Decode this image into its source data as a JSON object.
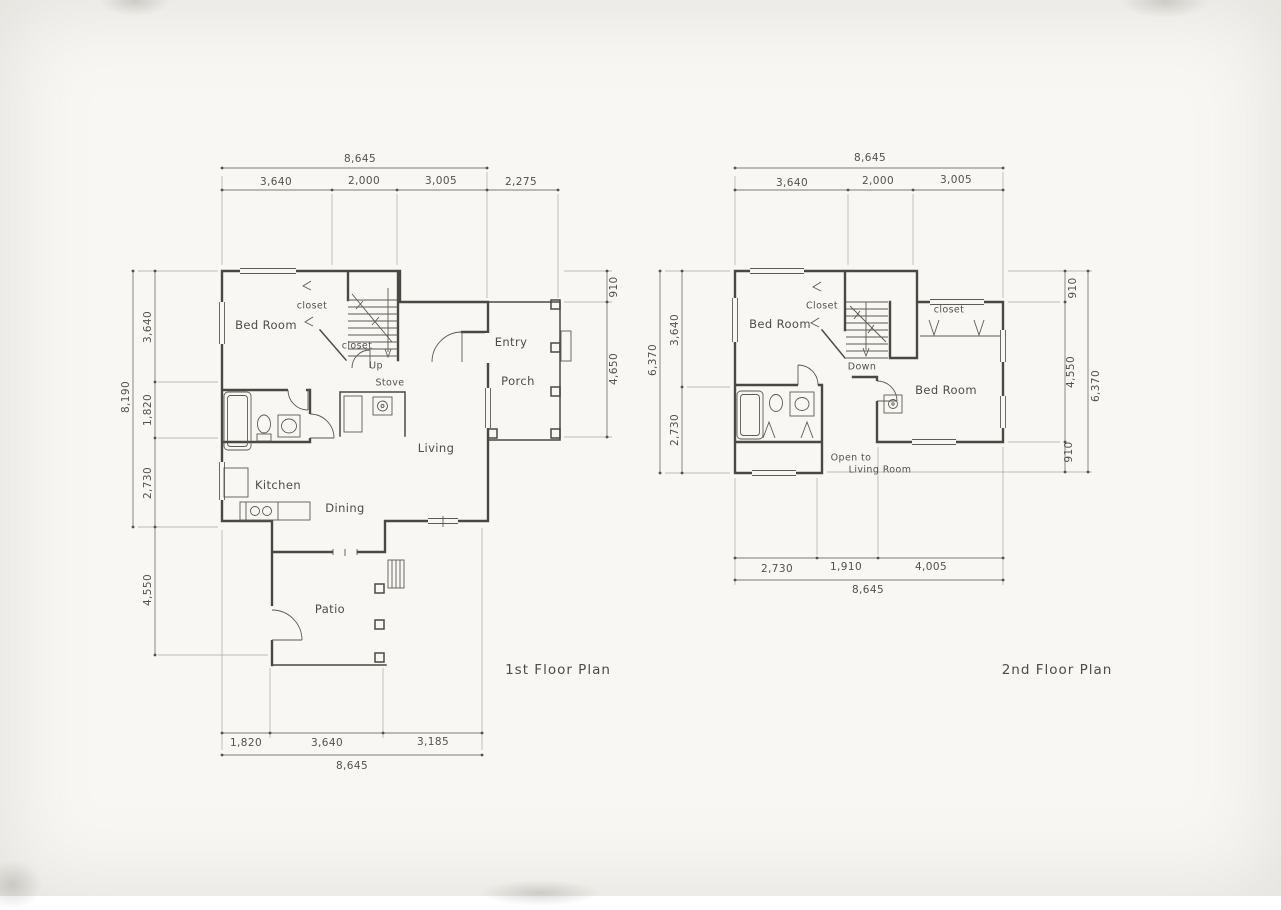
{
  "sheet": {
    "paper_color": "#f8f7f3",
    "ink_color": "#4a4840",
    "dim_color": "#7d7b73"
  },
  "first_floor": {
    "caption": "1st Floor Plan",
    "dims": {
      "top_overall": "8,645",
      "top_1": "3,640",
      "top_2": "2,000",
      "top_3": "3,005",
      "top_4": "2,275",
      "left_overall": "8,190",
      "left_1": "3,640",
      "left_2": "1,820",
      "left_3": "2,730",
      "left_4": "4,550",
      "right_1": "910",
      "right_2": "4,650",
      "bottom_1": "1,820",
      "bottom_2": "3,640",
      "bottom_3": "3,185",
      "bottom_overall": "8,645"
    },
    "labels": {
      "bedroom": "Bed Room",
      "closet_upper": "closet",
      "closet_stair": "closet",
      "up": "Up",
      "stove": "Stove",
      "entry": "Entry",
      "porch": "Porch",
      "living": "Living",
      "kitchen": "Kitchen",
      "dining": "Dining",
      "patio": "Patio"
    }
  },
  "second_floor": {
    "caption": "2nd Floor Plan",
    "dims": {
      "top_overall": "8,645",
      "top_1": "3,640",
      "top_2": "2,000",
      "top_3": "3,005",
      "left_overall": "6,370",
      "left_1": "3,640",
      "left_2": "2,730",
      "right_1": "910",
      "right_2": "4,550",
      "right_3": "910",
      "right_overall": "6,370",
      "bottom_1": "2,730",
      "bottom_2": "1,910",
      "bottom_3": "4,005",
      "bottom_overall": "8,645"
    },
    "labels": {
      "bedroom_left": "Bed Room",
      "closet_left": "Closet",
      "closet_right": "closet",
      "down": "Down",
      "bedroom_right": "Bed Room",
      "open_1": "Open to",
      "open_2": "Living Room"
    }
  }
}
